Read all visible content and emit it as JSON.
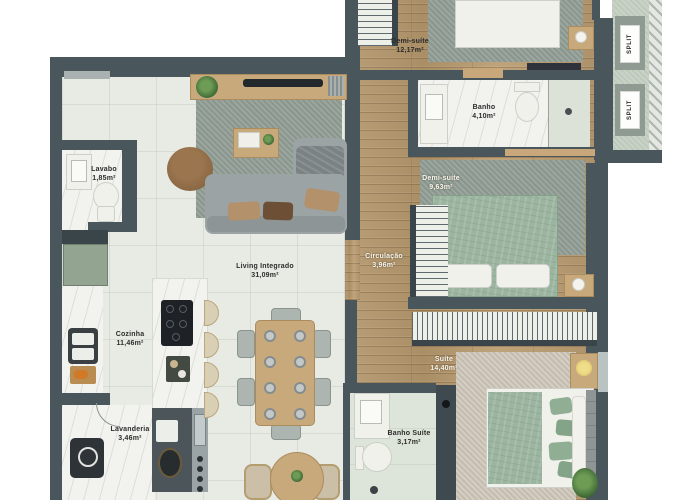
{
  "floorplan": {
    "rooms": [
      {
        "id": "lavabo",
        "name": "Lavabo",
        "area": "1,85m²",
        "label_style": "dark"
      },
      {
        "id": "cozinha",
        "name": "Cozinha",
        "area": "11,46m²",
        "label_style": "dark"
      },
      {
        "id": "lavanderia",
        "name": "Lavanderia",
        "area": "3,46m²",
        "label_style": "dark"
      },
      {
        "id": "living-integrado",
        "name": "Living Integrado",
        "area": "31,09m²",
        "label_style": "dark"
      },
      {
        "id": "demi-suite-1",
        "name": "Demi-suíte",
        "area": "12,17m²",
        "label_style": "dark"
      },
      {
        "id": "banho",
        "name": "Banho",
        "area": "4,10m²",
        "label_style": "dark"
      },
      {
        "id": "demi-suite-2",
        "name": "Demi-suíte",
        "area": "9,63m²",
        "label_style": "light"
      },
      {
        "id": "circulacao",
        "name": "Circulação",
        "area": "3,96m²",
        "label_style": "light"
      },
      {
        "id": "suite",
        "name": "Suíte",
        "area": "14,40m²",
        "label_style": "light"
      },
      {
        "id": "banho-suite",
        "name": "Banho Suíte",
        "area": "3,17m²",
        "label_style": "dark"
      }
    ],
    "split_units": [
      {
        "label": "SPLIT"
      },
      {
        "label": "SPLIT"
      }
    ],
    "colors": {
      "wall": "#49565b",
      "wood_floor": "#b29871",
      "tile_floor": "#e8ebe4",
      "marble": "#f2f3ef",
      "rug_gray": "#929f97",
      "rug_beige": "#cdc6b8",
      "bed_green": "#9cb5a0",
      "cabinet_green": "#93a491",
      "furniture_wood": "#c8a97c"
    }
  }
}
